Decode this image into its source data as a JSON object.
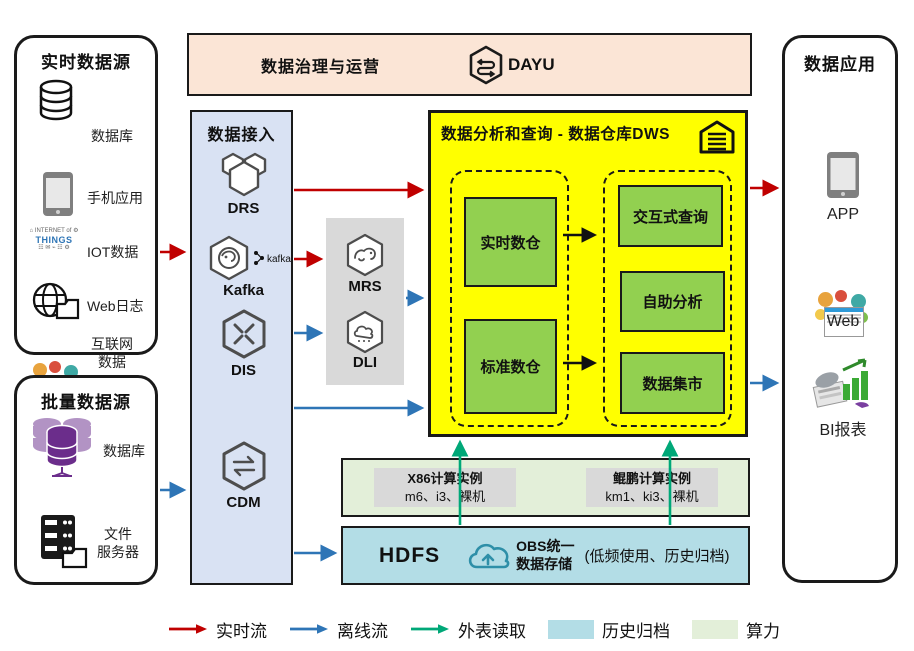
{
  "governance": {
    "title": "数据治理与运营",
    "product": "DAYU"
  },
  "realtime_sources": {
    "title": "实时数据源",
    "items": [
      {
        "icon": "database-icon",
        "label": "数据库"
      },
      {
        "icon": "mobile-phone-icon",
        "label": "手机应用"
      },
      {
        "icon": "iot-wordcloud-icon",
        "label": "IOT数据"
      },
      {
        "icon": "web-log-icon",
        "label": "Web日志"
      },
      {
        "icon": "internet-collage-icon",
        "label": "互联网\n数据"
      }
    ]
  },
  "batch_sources": {
    "title": "批量数据源",
    "items": [
      {
        "icon": "database-cluster-icon",
        "label": "数据库"
      },
      {
        "icon": "file-server-icon",
        "label": "文件\n服务器"
      }
    ]
  },
  "ingestion": {
    "title": "数据接入",
    "services": [
      {
        "icon": "drs-hexagon-icon",
        "label": "DRS"
      },
      {
        "icon": "kafka-hexagon-icon",
        "label": "Kafka",
        "badge": "kafka"
      },
      {
        "icon": "dis-hexagon-icon",
        "label": "DIS"
      },
      {
        "icon": "cdm-hexagon-icon",
        "label": "CDM"
      }
    ]
  },
  "processing": {
    "services": [
      {
        "icon": "mrs-hexagon-icon",
        "label": "MRS"
      },
      {
        "icon": "dli-hexagon-icon",
        "label": "DLI"
      }
    ]
  },
  "dws": {
    "title": "数据分析和查询 - 数据仓库DWS",
    "icon": "warehouse-icon",
    "left_group": [
      "实时数仓",
      "标准数仓"
    ],
    "right_group": [
      "交互式查询",
      "自助分析",
      "数据集市"
    ]
  },
  "compute": {
    "instances": [
      {
        "line1": "X86计算实例",
        "line2": "m6、i3、裸机"
      },
      {
        "line1": "鲲鹏计算实例",
        "line2": "km1、ki3、裸机"
      }
    ]
  },
  "storage": {
    "hdfs": "HDFS",
    "obs": "OBS统一\n数据存储",
    "note": "(低频使用、历史归档)"
  },
  "applications": {
    "title": "数据应用",
    "items": [
      {
        "icon": "mobile-phone-icon",
        "label": "APP"
      },
      {
        "icon": "web-collage-icon",
        "label": "Web"
      },
      {
        "icon": "bi-report-icon",
        "label": "BI报表"
      }
    ]
  },
  "legend": {
    "items": [
      {
        "type": "arrow",
        "color": "#C00000",
        "label": "实时流"
      },
      {
        "type": "arrow",
        "color": "#2E75B6",
        "label": "离线流"
      },
      {
        "type": "arrow",
        "color": "#00A878",
        "label": "外表读取"
      },
      {
        "type": "swatch",
        "color": "#B3DDE6",
        "label": "历史归档"
      },
      {
        "type": "swatch",
        "color": "#E3EFD9",
        "label": "算力"
      }
    ]
  },
  "colors": {
    "realtime_flow": "#C00000",
    "offline_flow": "#2E75B6",
    "external_read": "#00A878",
    "history_archive_bg": "#B3DDE6",
    "compute_bg": "#E3EFD9",
    "ingest_bg": "#D9E2F3",
    "governance_bg": "#FBE5D6",
    "dws_bg": "#FFFF00",
    "warehouse_green": "#92D050",
    "gray_panel": "#D9D9D9"
  }
}
